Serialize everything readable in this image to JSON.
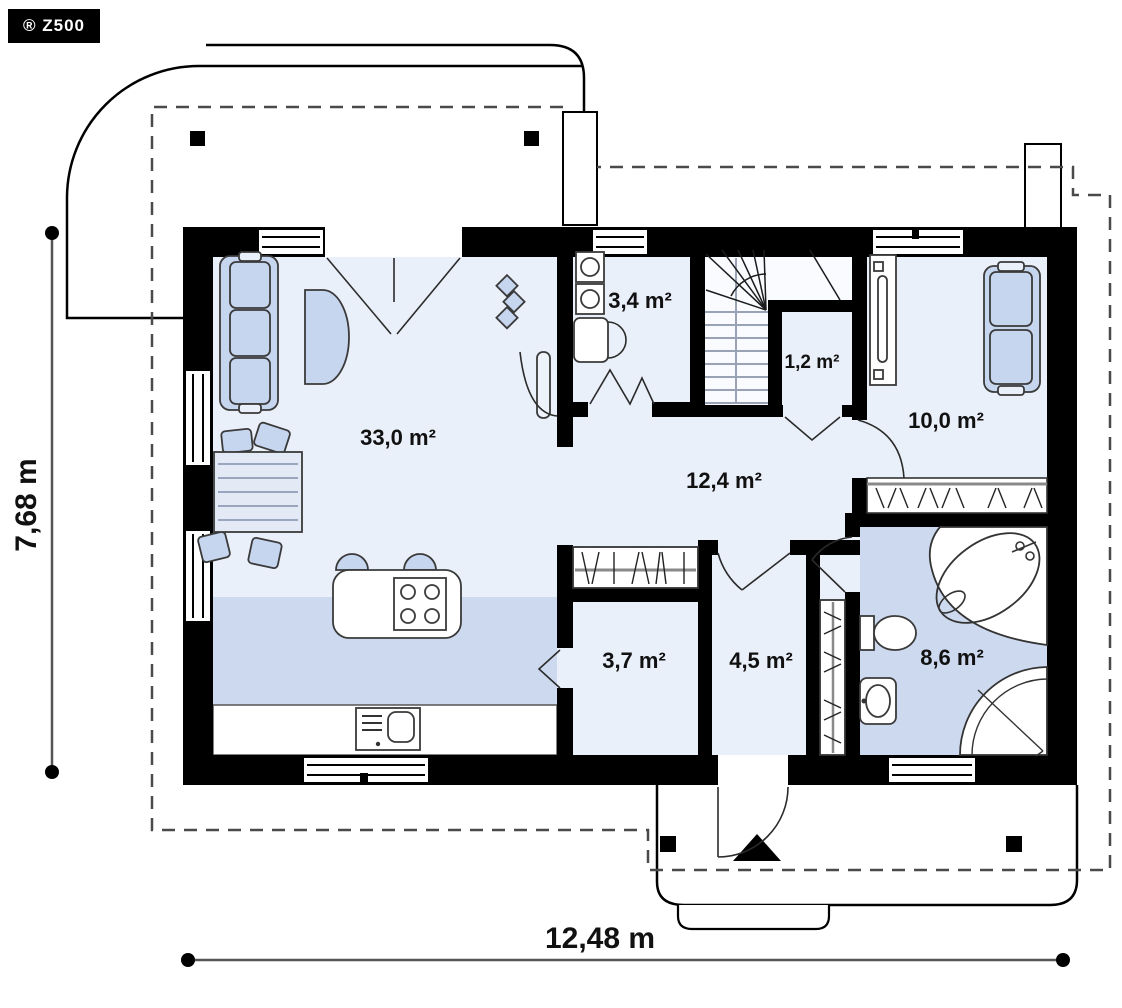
{
  "logo": {
    "text": "® Z500"
  },
  "plan": {
    "rooms": [
      {
        "id": "living-kitchen",
        "area_label": "33,0 m²"
      },
      {
        "id": "utility",
        "area_label": "3,4 m²"
      },
      {
        "id": "closet-under-stairs",
        "area_label": "1,2 m²"
      },
      {
        "id": "bedroom",
        "area_label": "10,0 m²"
      },
      {
        "id": "hall",
        "area_label": "12,4 m²"
      },
      {
        "id": "pantry-room",
        "area_label": "3,7 m²"
      },
      {
        "id": "vestibule",
        "area_label": "4,5 m²"
      },
      {
        "id": "bathroom",
        "area_label": "8,6 m²"
      }
    ],
    "dimensions": {
      "width_label": "12,48 m",
      "height_label": "7,68 m"
    },
    "colors": {
      "wall": "#000000",
      "floor_light": "#eaf0fa",
      "floor_dark": "#cdd9ee",
      "furniture_fill": "#c7d6ef",
      "stairwell": "#fafbfe",
      "dashed_outline": "#4a4a4a"
    }
  }
}
